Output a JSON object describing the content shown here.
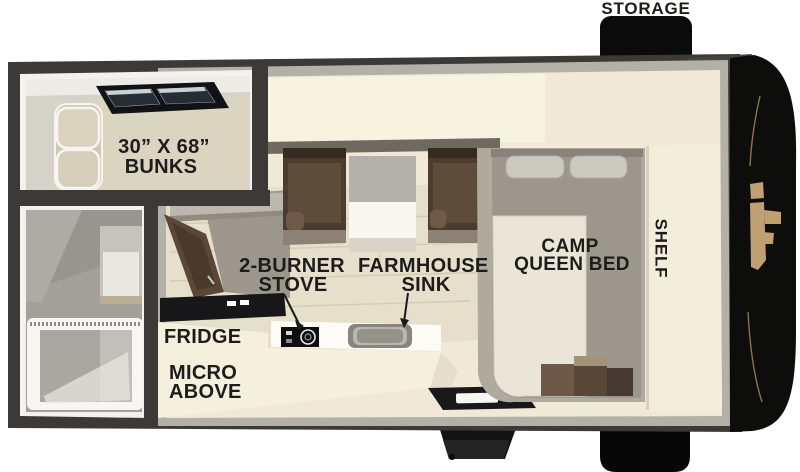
{
  "title": "Truck camper floor plan",
  "labels": {
    "storage": "STORAGE",
    "bunks_line1": "30” X 68”",
    "bunks_line2": "BUNKS",
    "stove_line1": "2-BURNER",
    "stove_line2": "STOVE",
    "sink_line1": "FARMHOUSE",
    "sink_line2": "SINK",
    "fridge": "FRIDGE",
    "micro_line1": "MICRO",
    "micro_line2": "ABOVE",
    "bed_line1": "CAMP",
    "bed_line2": "QUEEN BED",
    "shelf": "SHELF"
  },
  "colors": {
    "background": "#ffffff",
    "wall": "#3c3936",
    "liner_white": "#f2f1ec",
    "liner_gray": "#b3b0a8",
    "floor_cream": "#f0e9d7",
    "plank_floor": "#e6dfcb",
    "cabinet_cream": "#f5f0de",
    "seat_brown": "#4c3c2f",
    "fridge_brown": "#5a4737",
    "mattress_gray": "#9b978d",
    "bunk_beige": "#dad4c1",
    "bath_gray": "#a3a09a",
    "front_cap_black": "#0d0d0c",
    "emblem_tan": "#bfa072",
    "label_text": "#1d1c1a"
  }
}
